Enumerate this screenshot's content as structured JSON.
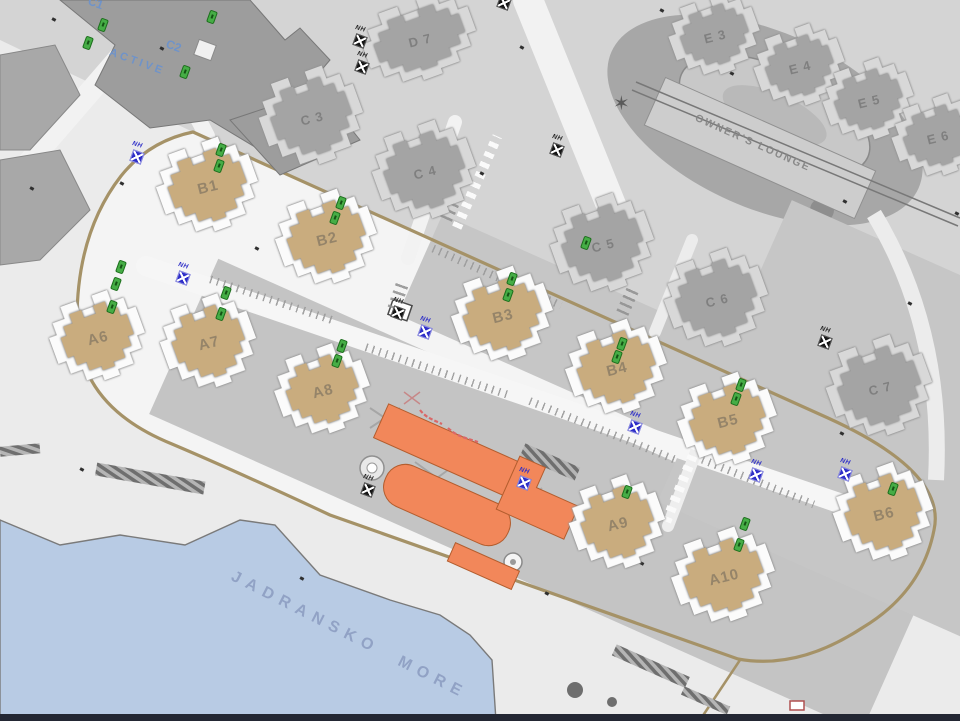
{
  "map": {
    "type": "resort-site-plan",
    "area_labels": {
      "sea": "JADRANSKO  MORE",
      "owners_lounge": "OWNER'S LOUNGE",
      "active": "ACTIVE",
      "c1": "C1",
      "c2": "C2"
    },
    "buildings": {
      "tan": [
        {
          "label": "B1",
          "x": 208,
          "y": 187
        },
        {
          "label": "B2",
          "x": 327,
          "y": 239
        },
        {
          "label": "B3",
          "x": 503,
          "y": 316
        },
        {
          "label": "B4",
          "x": 617,
          "y": 369
        },
        {
          "label": "B5",
          "x": 728,
          "y": 421
        },
        {
          "label": "B6",
          "x": 884,
          "y": 514
        },
        {
          "label": "A6",
          "x": 98,
          "y": 338
        },
        {
          "label": "A7",
          "x": 209,
          "y": 343
        },
        {
          "label": "A8",
          "x": 323,
          "y": 391
        },
        {
          "label": "A9",
          "x": 618,
          "y": 524
        },
        {
          "label": "A10",
          "x": 724,
          "y": 577
        }
      ],
      "gray": [
        {
          "label": "D 7",
          "x": 420,
          "y": 40
        },
        {
          "label": "C 3",
          "x": 312,
          "y": 118
        },
        {
          "label": "C 4",
          "x": 425,
          "y": 172
        },
        {
          "label": "C 5",
          "x": 603,
          "y": 245
        },
        {
          "label": "C 6",
          "x": 717,
          "y": 300
        },
        {
          "label": "C 7",
          "x": 880,
          "y": 388
        },
        {
          "label": "E 3",
          "x": 715,
          "y": 36
        },
        {
          "label": "E 4",
          "x": 800,
          "y": 67
        },
        {
          "label": "E 5",
          "x": 869,
          "y": 101
        },
        {
          "label": "E 6",
          "x": 938,
          "y": 137
        }
      ]
    },
    "markers": {
      "hydrant_label": "NH",
      "blue": [
        [
          137,
          157
        ],
        [
          183,
          278
        ],
        [
          425,
          332
        ],
        [
          635,
          427
        ],
        [
          756,
          475
        ],
        [
          845,
          474
        ],
        [
          524,
          483
        ]
      ],
      "black": [
        [
          360,
          41
        ],
        [
          362,
          67
        ],
        [
          504,
          3
        ],
        [
          557,
          150
        ],
        [
          398,
          313
        ],
        [
          825,
          342
        ],
        [
          368,
          490
        ]
      ],
      "green": [
        [
          103,
          25
        ],
        [
          88,
          43
        ],
        [
          212,
          17
        ],
        [
          185,
          72
        ],
        [
          221,
          150
        ],
        [
          219,
          166
        ],
        [
          341,
          203
        ],
        [
          335,
          218
        ],
        [
          512,
          279
        ],
        [
          508,
          295
        ],
        [
          622,
          344
        ],
        [
          617,
          357
        ],
        [
          741,
          385
        ],
        [
          736,
          399
        ],
        [
          893,
          489
        ],
        [
          121,
          267
        ],
        [
          116,
          284
        ],
        [
          112,
          307
        ],
        [
          226,
          293
        ],
        [
          221,
          314
        ],
        [
          342,
          346
        ],
        [
          337,
          361
        ],
        [
          627,
          492
        ],
        [
          745,
          524
        ],
        [
          739,
          545
        ],
        [
          586,
          243
        ]
      ],
      "specks": [
        [
          52,
          18
        ],
        [
          160,
          47
        ],
        [
          255,
          247
        ],
        [
          300,
          160
        ],
        [
          436,
          22
        ],
        [
          520,
          46
        ],
        [
          660,
          9
        ],
        [
          730,
          72
        ],
        [
          843,
          200
        ],
        [
          908,
          302
        ],
        [
          955,
          212
        ],
        [
          80,
          468
        ],
        [
          70,
          352
        ],
        [
          300,
          577
        ],
        [
          30,
          187
        ],
        [
          545,
          592
        ],
        [
          640,
          562
        ],
        [
          480,
          172
        ],
        [
          840,
          432
        ],
        [
          120,
          182
        ]
      ]
    },
    "annotations": {
      "red_script_note": "illegible red handwritten annotation near central buildings"
    },
    "colors": {
      "sea": "#b8cbe4",
      "building_tan": "#c9ac7e",
      "building_gray": "#a4a4a4",
      "orange": "#f2875a",
      "road_khaki": "#a59267",
      "marker_green": "#46ad46",
      "marker_blue": "#2e2ec8",
      "label_blue": "#6f93c9",
      "sea_label": "#8b9cc0",
      "red_annotation": "#d96868"
    }
  }
}
